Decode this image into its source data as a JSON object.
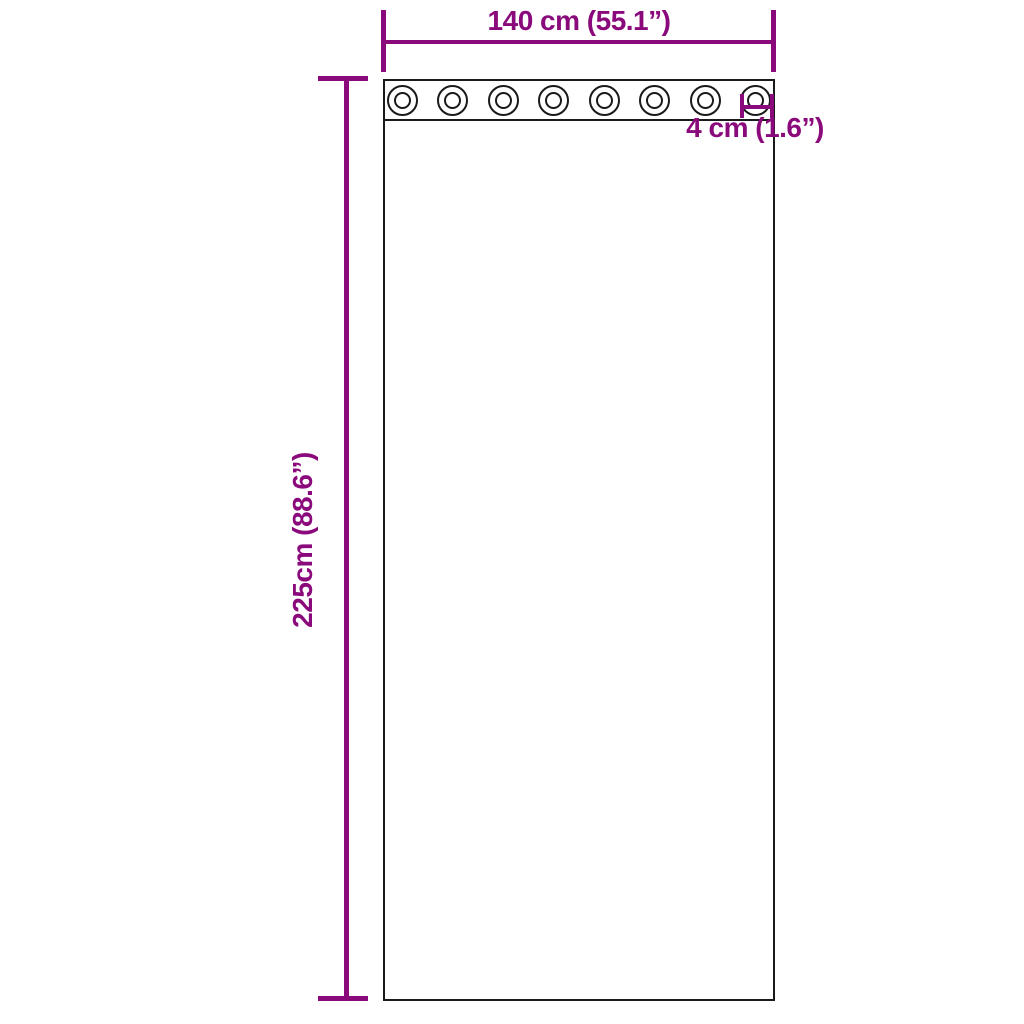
{
  "diagram": {
    "title": "curtain-dimension-diagram",
    "width_label": "140 cm (55.1”)",
    "height_label": "225cm (88.6”)",
    "grommet_label": "4 cm (1.6”)",
    "grommets": {
      "count": 8
    },
    "colors": {
      "dimension": "#8A0A7C",
      "outline": "#1A1A1A",
      "background": "#FFFFFF"
    }
  }
}
